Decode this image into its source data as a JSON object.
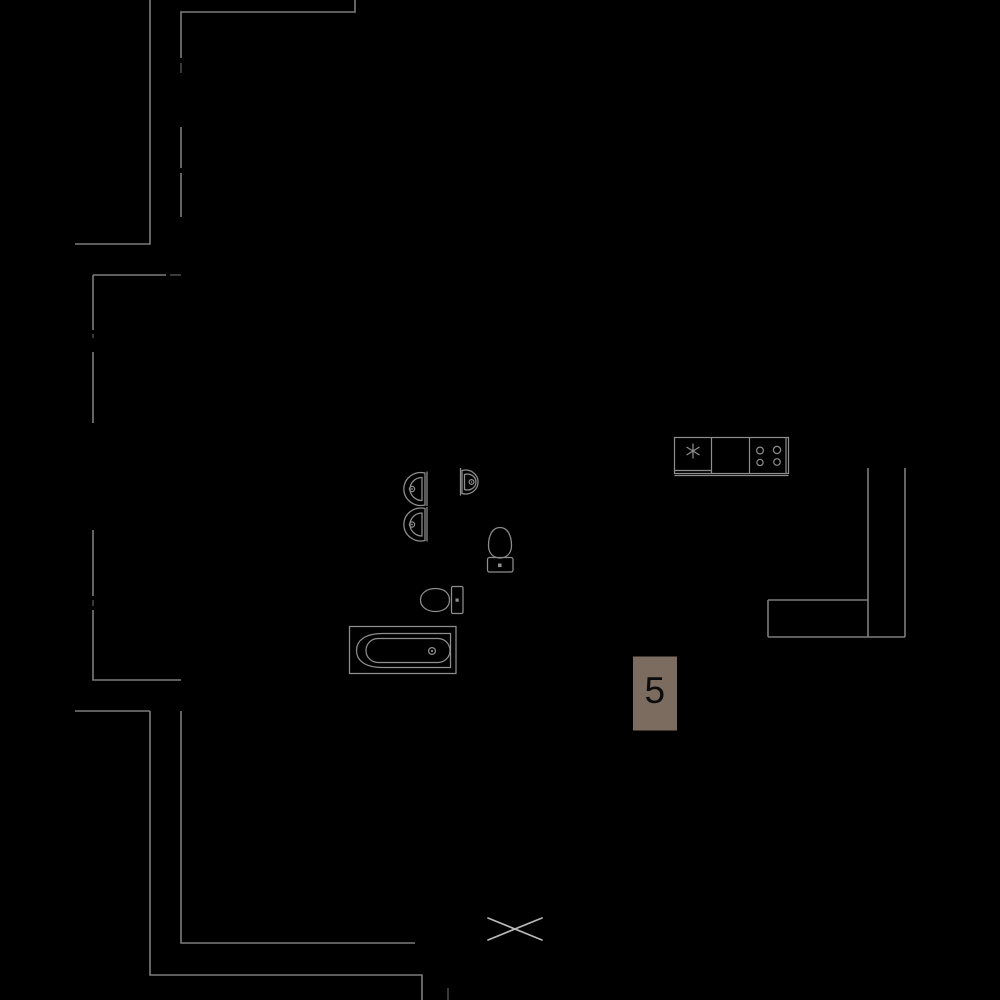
{
  "unit": {
    "number": "5",
    "badge_color": "#7c6b5f",
    "number_color": "#0b0b0b"
  },
  "palette": {
    "background": "#000000",
    "walls": "#7c7c7c",
    "walls_faint": "#5e5e5e",
    "fixtures": "#8e8e8e",
    "cross": "#b8b8b8"
  },
  "icons": {
    "fridge_asterisk": "asterisk-star",
    "stove_burners": "four-circles",
    "shaft_cross": "x-cross",
    "faucet_dot": "small-circle",
    "drain_dot": "small-circle"
  }
}
